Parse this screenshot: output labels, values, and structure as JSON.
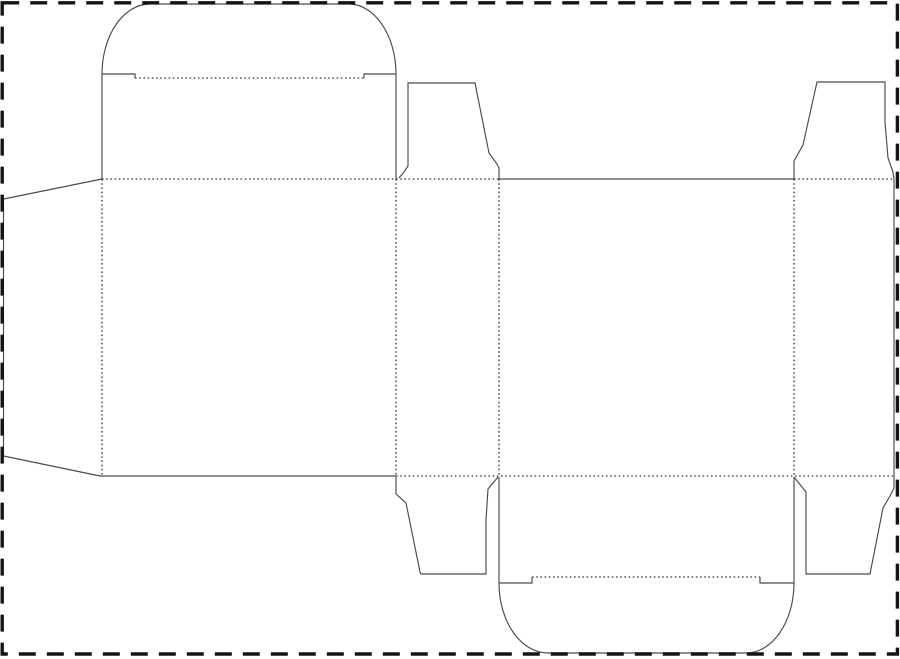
{
  "canvas": {
    "width": 900,
    "height": 659,
    "background": "#ffffff"
  },
  "border": {
    "name": "artboard-dashed-border",
    "color": "#141414",
    "stroke_width": 3.4,
    "dash": "17 11",
    "x": 2.2,
    "y": 2.8,
    "w": 895.2,
    "h": 651.2
  },
  "dieline": {
    "cut_color": "#4a4a4a",
    "cut_width": 1.15,
    "fold_color": "#333333",
    "fold_width": 1.3,
    "fold_dash": "1.6 2.6",
    "cut_paths": [
      {
        "name": "glue-flap-outline",
        "d": "M 102 179 L 3.5 199 L 3.5 456 L 100 476"
      },
      {
        "name": "top-tuck-flap-outline",
        "d": "M 102 179 L 102 74 C 102 35.3 123.5 4 150 4 L 349 4 C 374.5 4 396 35.3 396 74 L 396 179"
      },
      {
        "name": "top-tuck-notch-left",
        "d": "M 102 74 L 135 74 L 135 78"
      },
      {
        "name": "top-tuck-notch-right",
        "d": "M 396 74 L 364 74 L 364 78"
      },
      {
        "name": "top-dust-flap-left-outline",
        "d": "M 399 178 L 404 172 L 408 166 L 408 83 L 475 83 L 489 153 L 497 164 L 499 168 L 499 179"
      },
      {
        "name": "panel3-top-cut",
        "d": "M 499 179 L 794 179"
      },
      {
        "name": "top-dust-flap-right-outline",
        "d": "M 794 179 L 794 161 L 803 145 L 817 82 L 885 82 L 885 122 L 888 158 L 893 172 L 894 179"
      },
      {
        "name": "panel4-right-cut",
        "d": "M 894 179 L 894 488"
      },
      {
        "name": "bottom-dust-flap-right-outline",
        "d": "M 894 488 L 890 496 L 883 508 L 870 574 L 806 574 L 806 492 L 794 477"
      },
      {
        "name": "bottom-tuck-flap-outline",
        "d": "M 499 477 L 499 583 C 499 621.7 520.9 653 548 653 L 746 653 C 772.5 653 794 621.7 794 583 L 794 477"
      },
      {
        "name": "bottom-tuck-notch-left",
        "d": "M 499 583 L 532 583 L 532 577"
      },
      {
        "name": "bottom-tuck-notch-right",
        "d": "M 794 583 L 760 583 L 760 577"
      },
      {
        "name": "bottom-dust-flap-left-outline",
        "d": "M 396 477 L 396 494 L 406 503 L 420 572 L 421 574 L 486 574 L 486 520 L 488 489 L 498 477"
      },
      {
        "name": "panel1-bottom-cut",
        "d": "M 100 476 L 396 476"
      }
    ],
    "fold_paths": [
      {
        "name": "fold-top-band-left",
        "d": "M 102 179 L 499 179"
      },
      {
        "name": "fold-top-band-right",
        "d": "M 794 179 L 893 179"
      },
      {
        "name": "fold-bottom-band",
        "d": "M 396 476 L 893 476"
      },
      {
        "name": "fold-glue-flap",
        "d": "M 102 179 L 102 476"
      },
      {
        "name": "fold-panel1-panel2",
        "d": "M 396 179 L 396 476"
      },
      {
        "name": "fold-panel2-panel3",
        "d": "M 499 179 L 499 476"
      },
      {
        "name": "fold-panel3-panel4",
        "d": "M 794 179 L 794 476"
      },
      {
        "name": "fold-top-tuck-shoulder",
        "d": "M 135 78 L 364 78"
      },
      {
        "name": "fold-bottom-tuck-shoulder",
        "d": "M 532 577 L 760 577"
      }
    ]
  }
}
